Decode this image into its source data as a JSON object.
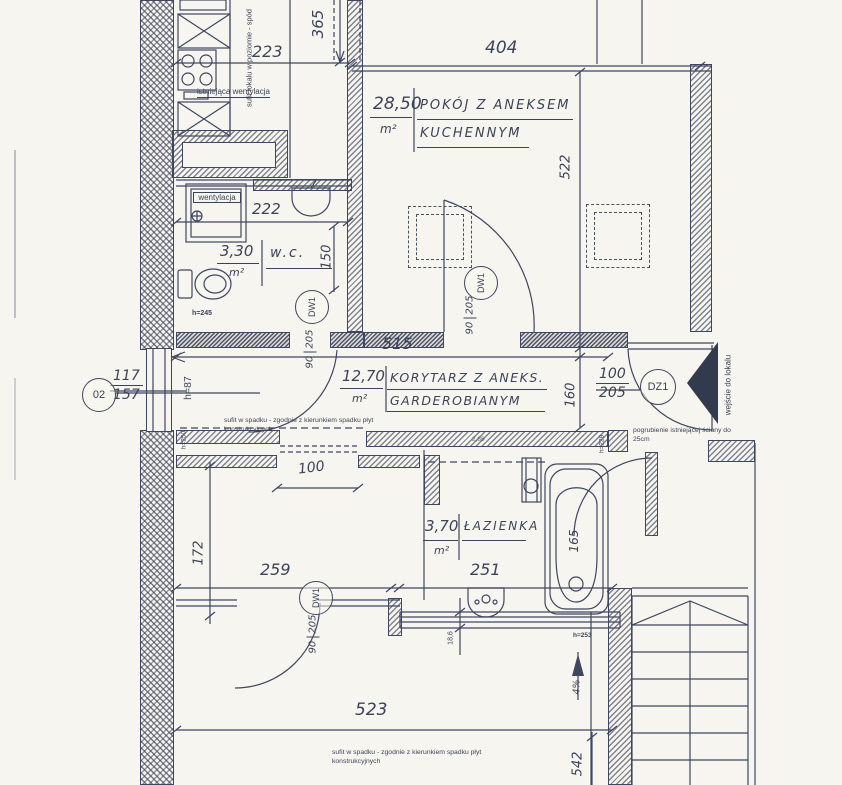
{
  "plan": {
    "rooms": {
      "pokoj": {
        "area": "28,50",
        "unit": "m²",
        "name_line1": "POKÓJ Z ANEKSEM",
        "name_line2": "KUCHENNYM"
      },
      "korytarz": {
        "area": "12,70",
        "unit": "m²",
        "name_line1": "KORYTARZ Z ANEKS.",
        "name_line2": "GARDEROBIANYM"
      },
      "wc": {
        "area": "3,30",
        "unit": "m²",
        "name": "w.c."
      },
      "lazienka": {
        "area": "3,70",
        "unit": "m²",
        "name": "ŁAZIENKA"
      }
    },
    "dims": {
      "d223": "223",
      "d365": "365",
      "d404": "404",
      "d522": "522",
      "d222": "222",
      "d150": "150",
      "d515": "515",
      "d160": "160",
      "d100e": "100",
      "d205e": "205",
      "d90": "90",
      "d205": "205",
      "d117": "117",
      "d157": "157",
      "d100": "100",
      "d172": "172",
      "d259": "259",
      "d251": "251",
      "d165": "165",
      "d523": "523",
      "d542": "542",
      "d186": "18,6",
      "d286": "2,86",
      "slope": "4%"
    },
    "heights": {
      "h245": "h=245",
      "h87": "h=87",
      "h250": "h=250",
      "h253": "h=253",
      "h228": "h=228"
    },
    "tags": {
      "dw1": "DW1",
      "dz1": "DZ1",
      "window02": "02"
    },
    "notes": {
      "vent_existing": "istniejąca wentylacja",
      "vent": "wentylacja",
      "ceiling_level": "sufit lokalu w poziomie - spód",
      "ceiling_slope": "sufit w spadku - zgodnie z kierunkiem spadku płyt konstrukcyjnych",
      "wall_thicken": "pogrubienie istniejącej ściany do 25cm",
      "entry": "wejście do lokalu"
    },
    "colors": {
      "ink": "#3b4357",
      "paper": "#f7f5ef"
    }
  }
}
